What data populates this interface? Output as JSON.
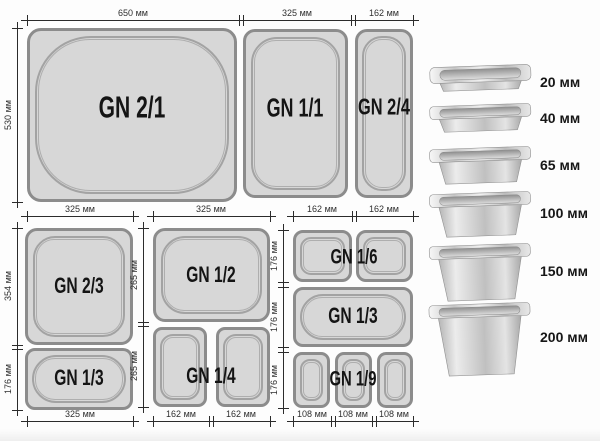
{
  "diagram": {
    "top_row": {
      "dims_top": [
        "650 мм",
        "325 мм",
        "162 мм"
      ],
      "dim_left": "530 мм",
      "pans": [
        {
          "label": "GN 2/1"
        },
        {
          "label": "GN 1/1"
        },
        {
          "label": "GN 2/4"
        }
      ]
    },
    "group_left": {
      "dim_top": "325 мм",
      "dims_left": [
        "354 мм",
        "176 мм"
      ],
      "dim_bottom": "325 мм",
      "pans": [
        {
          "label": "GN 2/3"
        },
        {
          "label": "GN 1/3"
        }
      ]
    },
    "group_middle": {
      "dim_top": "325 мм",
      "dims_left": [
        "265 мм",
        "265 мм"
      ],
      "dims_bottom": [
        "162 мм",
        "162 мм"
      ],
      "pans": [
        {
          "label": "GN 1/2"
        },
        {
          "label": "GN 1/4"
        }
      ]
    },
    "group_right": {
      "dims_top": [
        "162 мм",
        "162 мм"
      ],
      "dims_left": [
        "176 мм",
        "176 мм",
        "176 мм"
      ],
      "dims_bottom": [
        "108 мм",
        "108 мм",
        "108 мм"
      ],
      "pans": [
        {
          "label": "GN 1/6"
        },
        {
          "label": "GN 1/3"
        },
        {
          "label": "GN 1/9"
        }
      ]
    }
  },
  "depth_legend": {
    "items": [
      {
        "label": "20 мм"
      },
      {
        "label": "40 мм"
      },
      {
        "label": "65 мм"
      },
      {
        "label": "100 мм"
      },
      {
        "label": "150 мм"
      },
      {
        "label": "200 мм"
      }
    ]
  },
  "colors": {
    "pan_fill": "#d7d7d7",
    "pan_border": "#8c8c8c",
    "dim_line": "#2b2b2b",
    "label_text": "#141414"
  }
}
